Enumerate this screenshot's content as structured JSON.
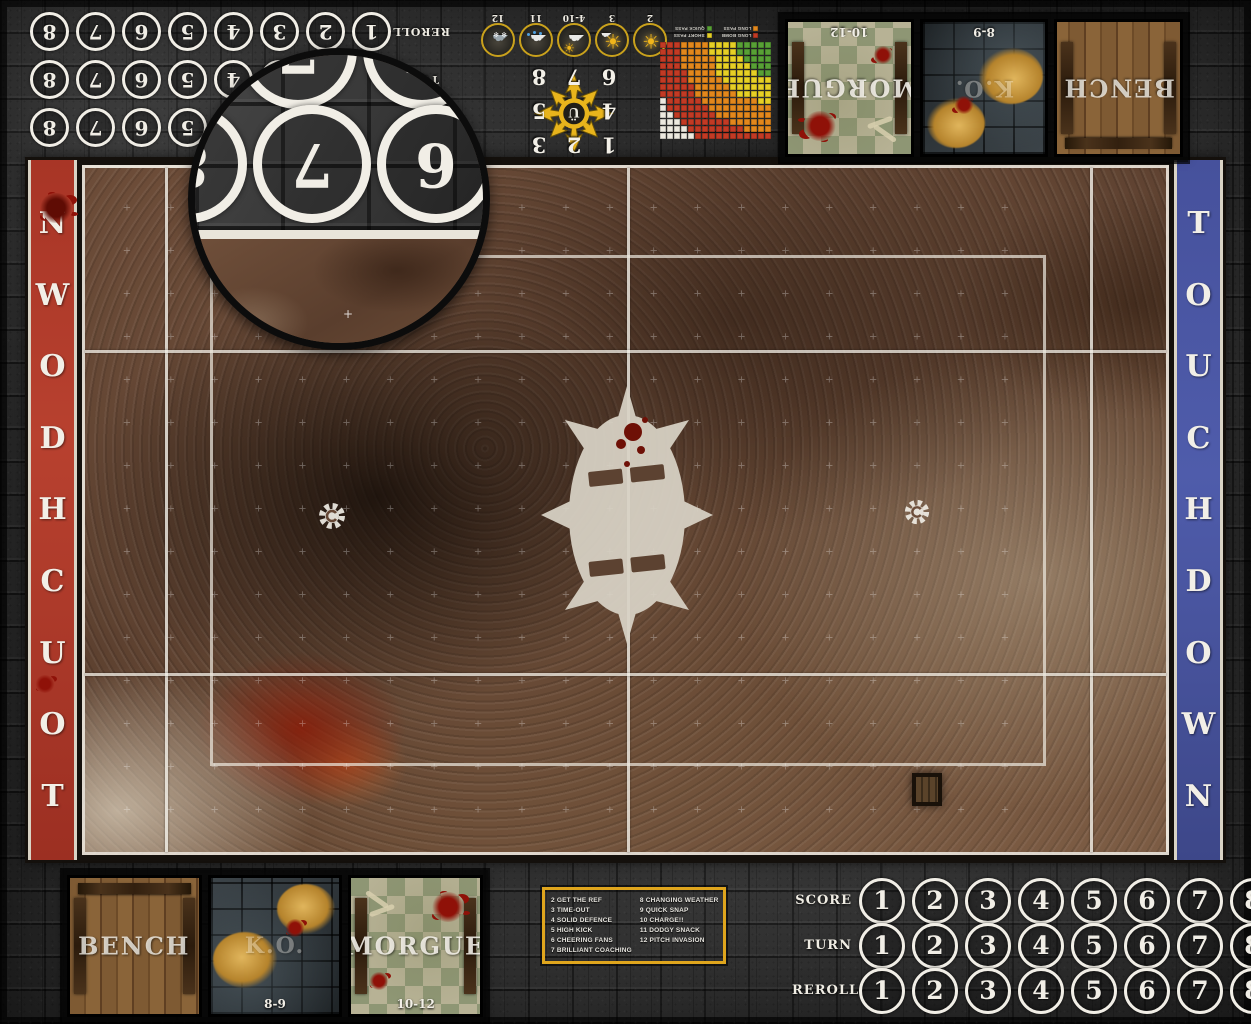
{
  "board": {
    "title": "Blood Bowl fantasy football pitch mat",
    "colors": {
      "accent_yellow": "#dfa51d",
      "banner_red": "#b2392b",
      "banner_blue": "#4c58a6",
      "line_white": "#f2efe7",
      "mud_brown": "#6b4b38",
      "stone_gray": "#2e2e2e"
    }
  },
  "trackers": {
    "rows": [
      {
        "label": "SCORE",
        "numbers": [
          "1",
          "2",
          "3",
          "4",
          "5",
          "6",
          "7",
          "8"
        ]
      },
      {
        "label": "TURN",
        "numbers": [
          "1",
          "2",
          "3",
          "4",
          "5",
          "6",
          "7",
          "8"
        ]
      },
      {
        "label": "REROLL",
        "numbers": [
          "1",
          "2",
          "3",
          "4",
          "5",
          "6",
          "7",
          "8"
        ]
      }
    ]
  },
  "magnifier": {
    "main_row": [
      "8",
      "7",
      "6",
      "5"
    ],
    "top_row": [
      "7",
      "6"
    ]
  },
  "weather": {
    "entries": [
      {
        "value": "2",
        "icon": "sun-icon"
      },
      {
        "value": "3",
        "icon": "sun-small-cloud-icon"
      },
      {
        "value": "4-10",
        "icon": "cloud-sun-icon"
      },
      {
        "value": "11",
        "icon": "rain-cloud-icon"
      },
      {
        "value": "12",
        "icon": "storm-cloud-icon"
      }
    ]
  },
  "scatter": {
    "numbers": [
      "1",
      "2",
      "3",
      "4",
      "5",
      "6",
      "7",
      "8"
    ]
  },
  "range_ruler": {
    "legend": [
      {
        "label": "LONG BOMB",
        "color": "#c23a24"
      },
      {
        "label": "LONG PASS",
        "color": "#e2871c"
      },
      {
        "label": "SHORT PASS",
        "color": "#e6cf25"
      },
      {
        "label": "QUICK PASS",
        "color": "#58a035"
      }
    ],
    "cols": 16,
    "rows": 14,
    "band_radii": [
      4.2,
      8.2,
      12.4,
      16.9
    ],
    "out_of_range_color": "#ece9df"
  },
  "dugout": {
    "boxes": [
      {
        "type": "bench",
        "label": "BENCH",
        "range": ""
      },
      {
        "type": "ko",
        "label": "K.O.",
        "range": "8-9"
      },
      {
        "type": "morgue",
        "label": "MORGUE",
        "range": "10-12"
      }
    ]
  },
  "pitch": {
    "touchdown": "TOUCHDOWN"
  },
  "kickoff_table": {
    "left": [
      "2 GET THE REF",
      "3 TIME-OUT",
      "4 SOLID DEFENCE",
      "5 HIGH KICK",
      "6 CHEERING FANS",
      "7 BRILLIANT COACHING"
    ],
    "right": [
      "8 CHANGING WEATHER",
      "9 QUICK SNAP",
      "10 CHARGE!!",
      "11 DODGY SNACK",
      "12 PITCH INVASION"
    ]
  }
}
